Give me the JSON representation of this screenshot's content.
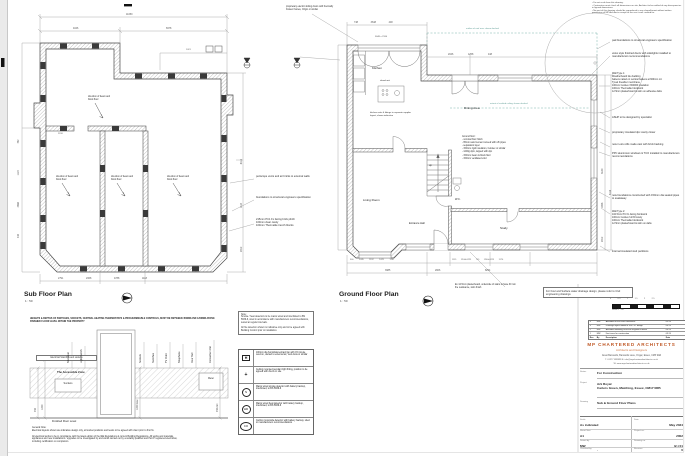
{
  "colors": {
    "accent": "#c05a28",
    "teal": "#5f9d95",
    "line": "#4a4a4a"
  },
  "notes_top_right": "• Do not scale from this drawing.\n• Contractors must check all dimensions on site, Architect to be notified of any discrepancies in figured dimensions.\n• No part of this drawing should be reproduced in any shape/format without written permission of MP Architects except for the use it was created for.",
  "sub_plan": {
    "title": "Sub Floor Plan",
    "scale": "1 : 50",
    "beam_label": "direction of beam and block floor",
    "dims": {
      "top_overall": "11050",
      "top_left": "4046",
      "top_right": "6978",
      "top_small": "1021",
      "left_col": "448   4888   1124   752",
      "right_col": "2912   1124   8116",
      "bottom_row": "2791   2368   4788   1118",
      "interior": "2198"
    },
    "annotations": {
      "periscope": "periscope vents and air bricks to external walls",
      "foundations": "foundations to structural engineers specification",
      "plinth": "215mm PC1 FL facing brick plinth\n100mm clear cavity\n100mm Thermalite trench blocks"
    }
  },
  "ground_plan": {
    "title": "Ground Floor Plan",
    "scale": "1 : 50",
    "rooms": {
      "kitchen": "Kitchen",
      "dining": "Dining Area",
      "living": "Living Room",
      "study": "Study",
      "hall": "Entrance Hall",
      "wc": "W.C.",
      "up": "up"
    },
    "kitchen_note": "kitchen units & fittings to separate supplier layout, shown indicative",
    "island_label": "island unit",
    "bifold_dim": "3648 x 2184",
    "roof_note": "outline of roof over shown dashed",
    "vault_note": "extent of vaulted ceiling shown dashed",
    "floor_buildup": "Ground floor:\n- nominal floor finish\n- 65mm sand cement screed with ufh pipes\n- separation layer\n- 150mm rigid insulation, Celotex or similar\n- 1200g dpm, lapped with dpc\n- 150mm beam & block floor\n- 150mm ventilated void",
    "lintel_note": "proprietary electric sliding doors with thermally broken frames, Origin or similar",
    "plasterboard_note": "Ex 12.5mm plasterboard, underside of stairs to have 30 min fire resistance, skim finish",
    "dims": {
      "top_row": "748   3648   448",
      "top_right_row": "2046   1258   448",
      "right_col": "2912   1858   3180",
      "right_col2": "8116",
      "bottom_row1": "900  2035  1192  1025  1110",
      "bottom_row2": "1115  1244x1225  719  1244x1225  1170",
      "bottom_row3": "3985   2906   8254"
    }
  },
  "right_column": {
    "pad_foundations": "pad foundations to structural engineers specification",
    "velux": "velux style finished doors with sidelights installed to manufacturers recommendations",
    "wall_type_1": "Wall Type 1:\nWeatherboard tile cladding\nbattens nailed on vertical battens at 600mm c/c\nTyvek breather membrane\n100mm Celotex XR4000 insulation\n100mm Thermalite blockwork\n12.5mm plasterboard & skim on adhesive dabs",
    "ashp": "ASHP to be designed by specialist",
    "dpc": "proprietary insulated dpc cavity closer",
    "cills": "new in-situ cills made cast with brick backing",
    "ppc": "PPC aluminium windows & TCO installed to manufacturers recommendations",
    "drainage_pipes": "new foundations constructed with 150mm dia sealed pipes to soakaway",
    "wall_type_2": "Wall Type 2:\n102.5mm PC FL facing brickwork\n100mm Celotex full fill cavity\n100mm Thermalite blockwork\n12.5mm plasterboard & skim on dabs",
    "stud": "internal insulated stud partitions"
  },
  "legend": {
    "note": "Note:\nSmoke / heat detectors to be mains wired and interlinked to BS 5839-6, sited in accordance with manufacturers recommendations, tested at regular intervals.\n\nAll fire detection shown is indicative only and to be agreed with Building Control prior to installation.",
    "rows": [
      {
        "symbol": "H",
        "desc": "100mm dia humidistat extract fan with 15 minute overrun, ducted to external air, Vent-Axia or similar"
      },
      {
        "symbol": "+",
        "desc": "Ceiling mounted pendant light fitting, position to be agreed with client on site"
      },
      {
        "symbol": "S",
        "desc": "Mains wired smoke detector with battery backup, interlinked, to BS 5839-6"
      },
      {
        "symbol": "HD",
        "desc": "Mains wired heat detector with battery backup, interlinked, to BS 5839-6"
      },
      {
        "symbol": "CO",
        "desc": "Carbon monoxide detector with battery backup, sited to manufacturers recommendations"
      }
    ]
  },
  "socket_detail": {
    "header": "HEIGHTS & DEPTHS OF SWITCHES, SOCKETS, CENTRAL HEATING THERMOSTATS & PROGRAMMABLE CONTROLS, MUST BE BETWEEN 450MM AND 1200MM ABOVE FINISHED FLOOR LEVEL WITHIN THE PROPERTY",
    "box_label": "Electrical Switches and sockets",
    "labels": [
      "Television",
      "Light Switch",
      "Sockets",
      "Switches",
      "TV Point",
      "Telephone",
      "Door Bell",
      "Consumer Unit"
    ],
    "zone": "The Accessible Zone",
    "sockets": "Sockets",
    "meter": "Meter",
    "ffl": "Finished Floor Level",
    "dim_450a": "450",
    "dim_1200a": "1200",
    "dim_1200b": "1200 max",
    "dim_450b": "450 min",
    "general_note": "General Note:\nElectrical layouts shown are indicative design only, all socket positions and levels to be agreed with client prior to first fix.\n\nAll electrical works to be in compliance with the latest edition of the IEE Regulations & current Building Regulations. All works and materials, appliances and new installations / upgrades to be investigated by and works carried out by a suitably qualified and Part P registered electrician, including certification on completion."
  },
  "drainage_note": "For Foul and Surface water drainage design, please refer to Civil engineering drawings",
  "scale_bar": {
    "ticks": "0   0.5   1   1.5   2   2.5",
    "caption": "Scale 1 : 50"
  },
  "revisions": {
    "rows": [
      [
        "4",
        "MW",
        "Amended to suit client comments",
        "05.24"
      ],
      [
        "3",
        "MW",
        "Drainage layout added to suit C.E. design",
        "04.24"
      ],
      [
        "2",
        "MW",
        "Amended following structural engineers details",
        "04.24"
      ],
      [
        "1",
        "MW",
        "First issue for construction",
        "03.24"
      ]
    ],
    "header": [
      "Rev",
      "By",
      "Description",
      "Date"
    ]
  },
  "title_block": {
    "firm": "MP CHARTERED ARCHITECTS",
    "firm_sub": "Architects and Designers",
    "address": "Great Bannards, Bannards Lane, Ongar, Essex, CM5 9AR",
    "contact": "T. 01277 899999      E. info@mpcharteredarchitects.co.uk",
    "web": "W. www.mpcharteredarchitects.co.uk",
    "status_label": "Status",
    "status": "For Construction",
    "project_label": "Project",
    "project": "Ark Royal\nCarters Green, Matching, Essex, CM17 0RB",
    "drawing_label": "Drawing",
    "drawing": "Sub & Ground Floor Plans",
    "scale_label": "Scale",
    "scale": "As indicated",
    "date_label": "Date",
    "date": "May 2024",
    "sheet_label": "Sheet Size",
    "sheet": "A1",
    "projno_label": "Project no.",
    "projno": "2002",
    "drawn_label": "Drawn by",
    "drawn": "MW",
    "dwgno_label": "Drawing no.",
    "dwgno": "(2-) 01",
    "checked_label": "Checked by",
    "checked": "-",
    "rev_label": "Revision",
    "rev": "0"
  }
}
